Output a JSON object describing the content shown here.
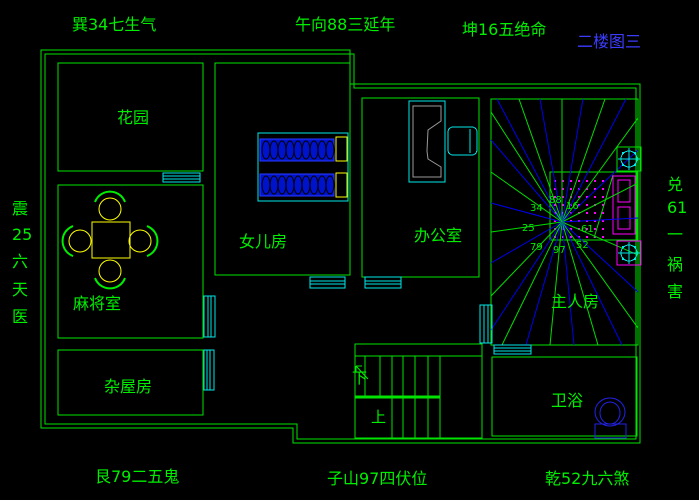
{
  "title": "二楼图三",
  "compass": {
    "top_left": "巽34七生气",
    "top_center": "午向88三延年",
    "top_right": "坤16五绝命",
    "bottom_left": "艮79二五鬼",
    "bottom_center": "子山97四伏位",
    "bottom_right": "乾52九六煞",
    "left": [
      "震",
      "25",
      "六",
      "天",
      "医"
    ],
    "right": [
      "兑",
      "61",
      "一",
      "祸",
      "害"
    ]
  },
  "rooms": {
    "garden": "花园",
    "daughter_room": "女儿房",
    "office": "办公室",
    "master_bedroom": "主人房",
    "mahjong_room": "麻将室",
    "storage_room": "杂屋房",
    "bathroom": "卫浴"
  },
  "stairs": {
    "down": "下",
    "up": "上"
  },
  "star_numbers": [
    "34",
    "88",
    "16",
    "25",
    "61",
    "79",
    "97",
    "52"
  ],
  "colors": {
    "background": "#000000",
    "wall_green": "#00e400",
    "window_cyan": "#00e8e8",
    "furniture_yellow": "#ffff00",
    "bed_blue": "#0013cc",
    "accent_magenta": "#ff00ff",
    "ray_green": "#00dd00",
    "ray_blue": "#0000ee",
    "title_blue": "#3c3cff",
    "desk_gray": "#9a9a9a"
  }
}
